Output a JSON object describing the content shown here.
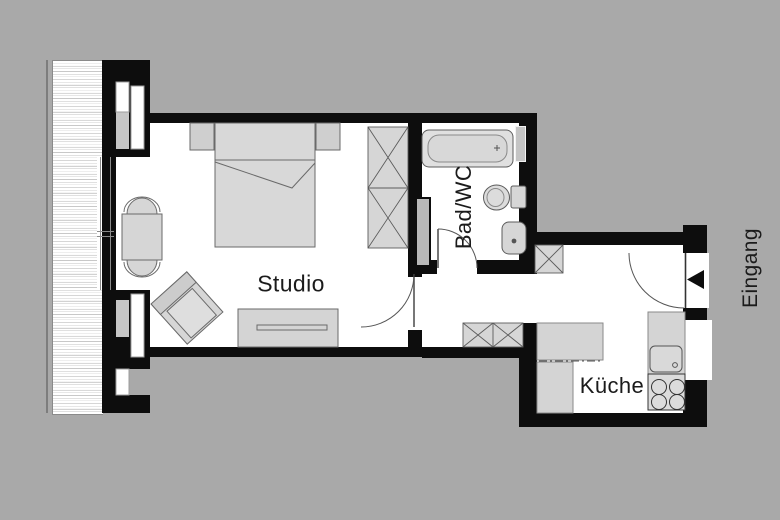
{
  "plan_title": "Apartment floor plan",
  "rooms": {
    "studio": {
      "label": "Studio"
    },
    "bath": {
      "label": "Bad/WC"
    },
    "kitchen": {
      "label": "Küche"
    },
    "entrance": {
      "label": "Eingang"
    }
  },
  "icons": {
    "entrance_arrow": "left-pointing-triangle"
  },
  "colors": {
    "background": "#a9a9a9",
    "wall": "#0d0d0d",
    "floor": "#ffffff",
    "furniture_fill": "#d6d6d6",
    "outline": "#5c5c5c"
  },
  "furniture": {
    "studio": [
      "double-bed",
      "nightstand-left",
      "nightstand-right",
      "wardrobe",
      "dining-table",
      "dining-chair-top",
      "dining-chair-bottom",
      "armchair",
      "sideboard"
    ],
    "bath": [
      "bathtub",
      "toilet",
      "washbasin"
    ],
    "hall": [
      "small-wardrobe",
      "hall-cabinet"
    ],
    "kitchen": [
      "counter-l",
      "counter-back",
      "kitchen-sink",
      "stove"
    ]
  }
}
